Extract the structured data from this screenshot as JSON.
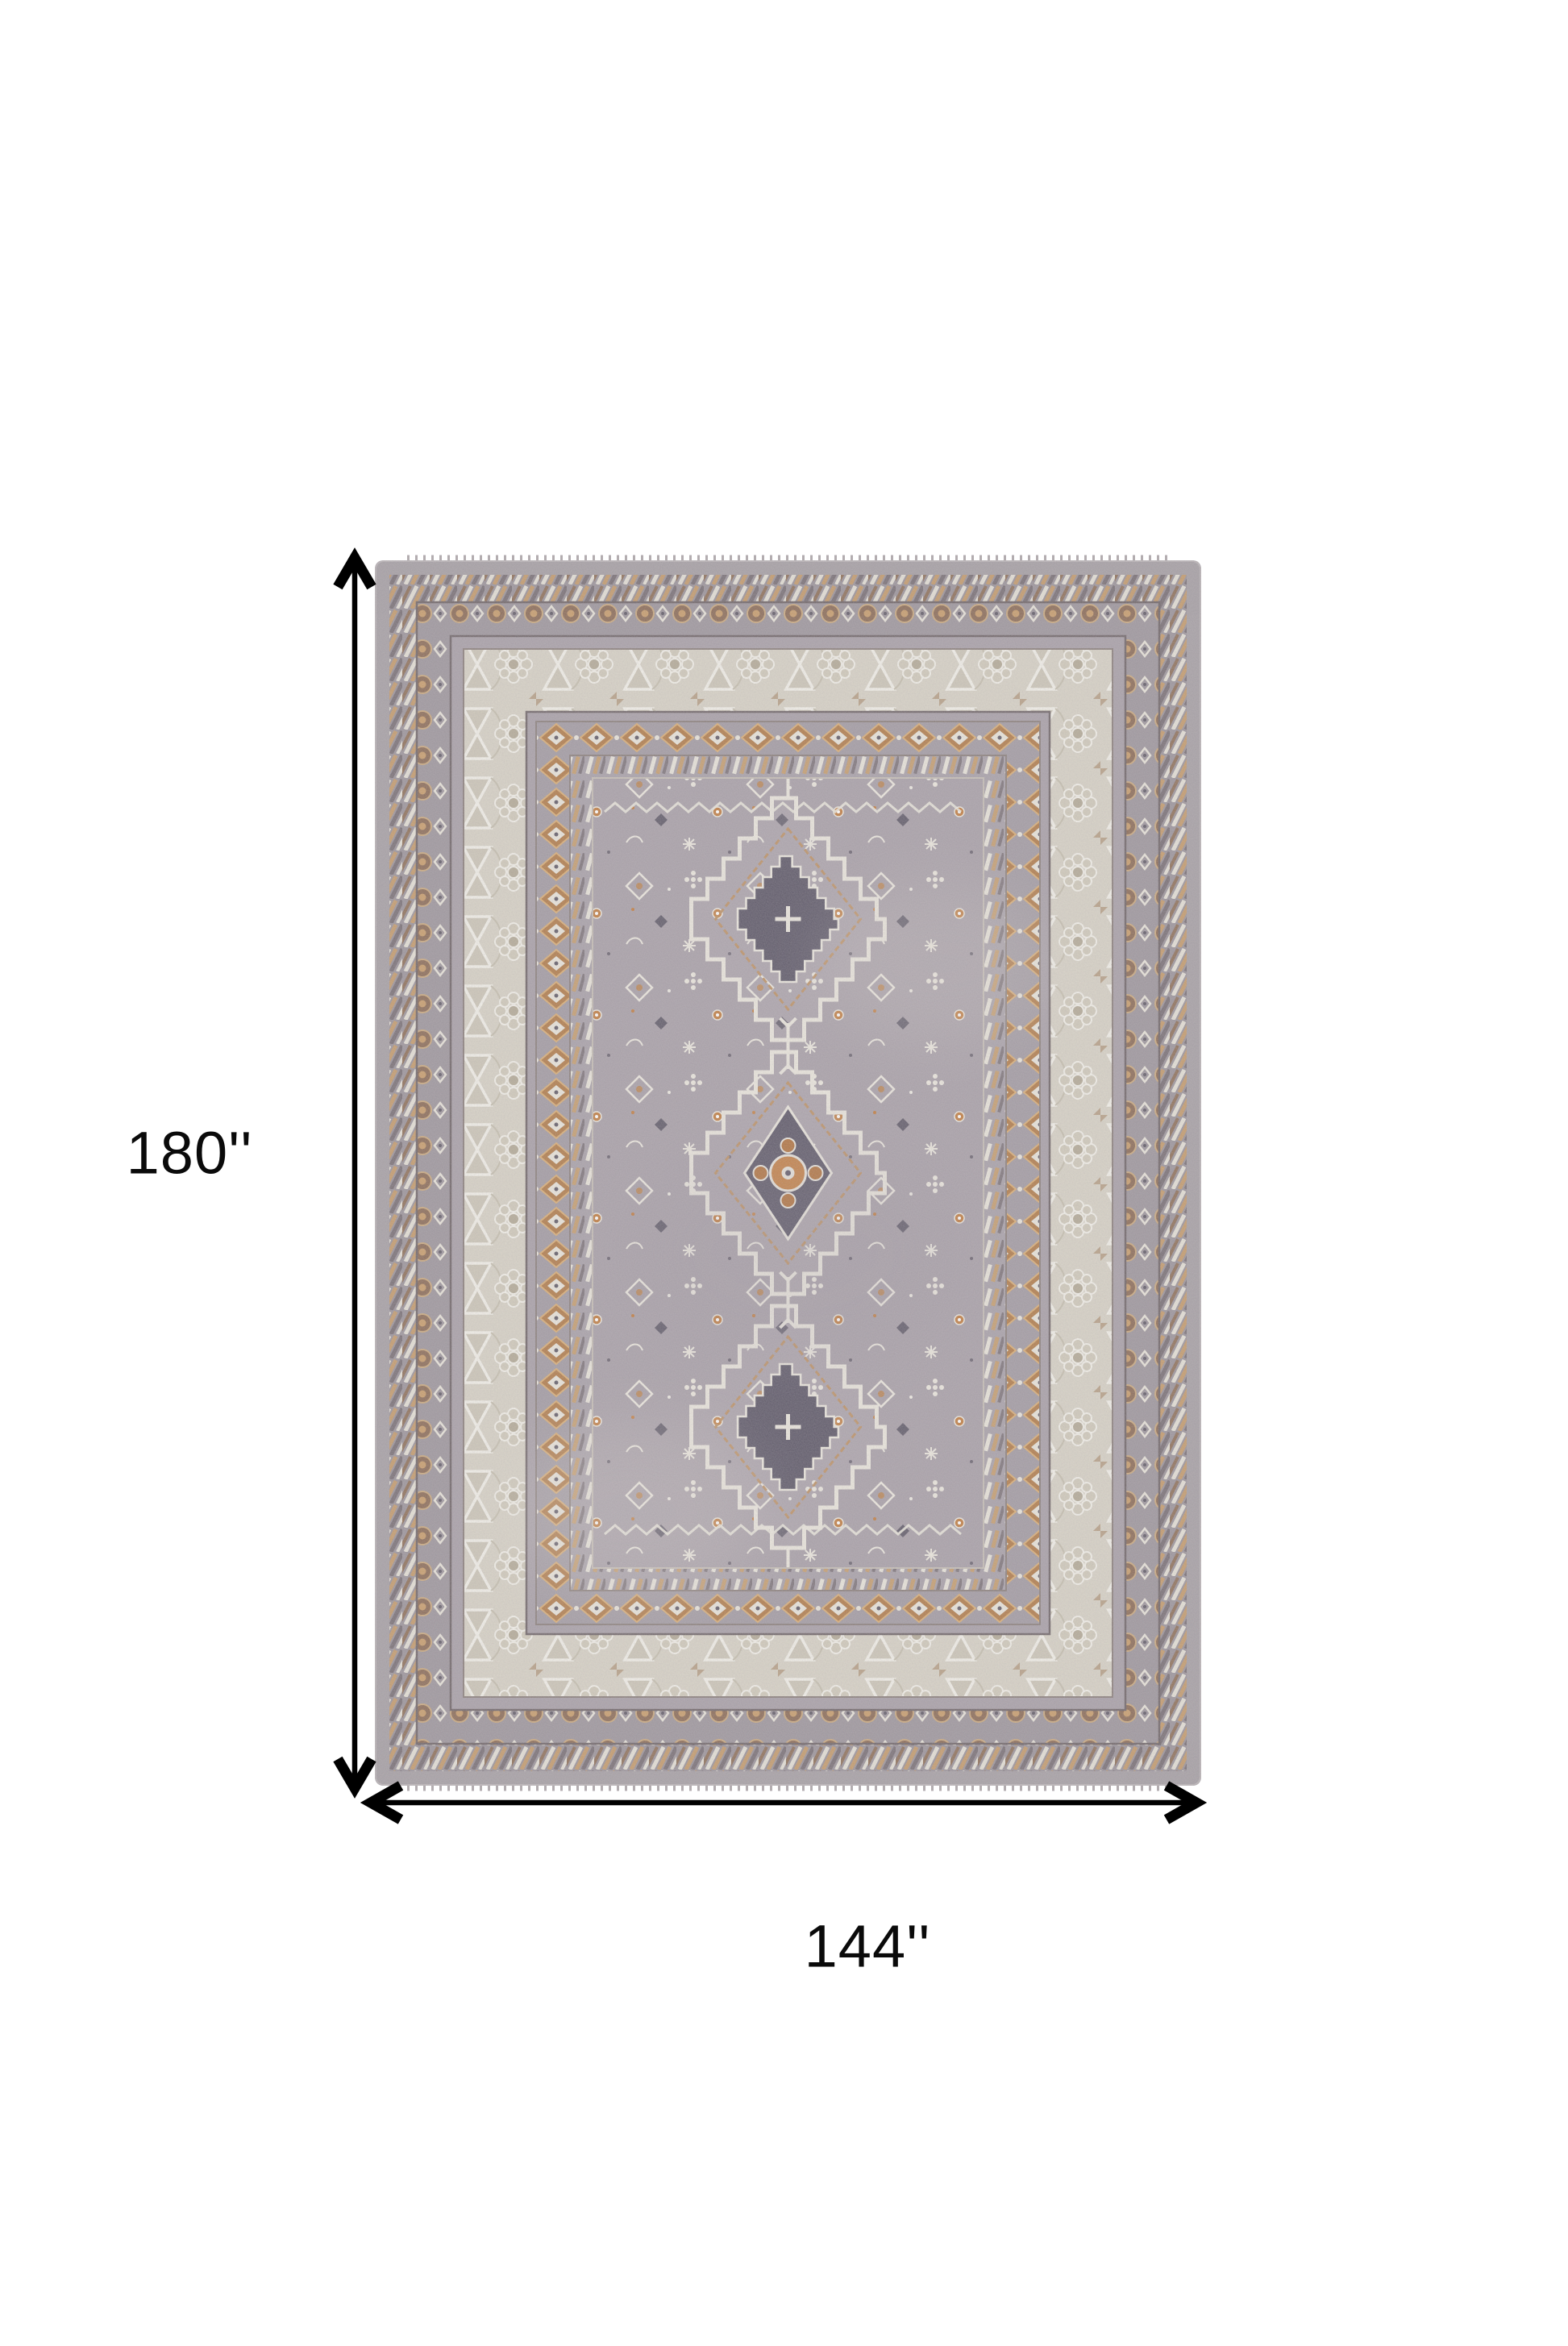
{
  "page": {
    "background": "#ffffff"
  },
  "dimensions": {
    "height_label": "180''",
    "width_label": "144''"
  },
  "palette": {
    "arrow": "#000000",
    "label_text": "#0a0a0a",
    "rug_edge": "#a59fa4",
    "rug_field": "#a79fa7",
    "ivory_border": "#d6d1c5",
    "accent_orange": "#c57f42",
    "accent_brown": "#8a6b57",
    "accent_dark": "#5b5666",
    "motif_cream": "#e9e5dc"
  }
}
